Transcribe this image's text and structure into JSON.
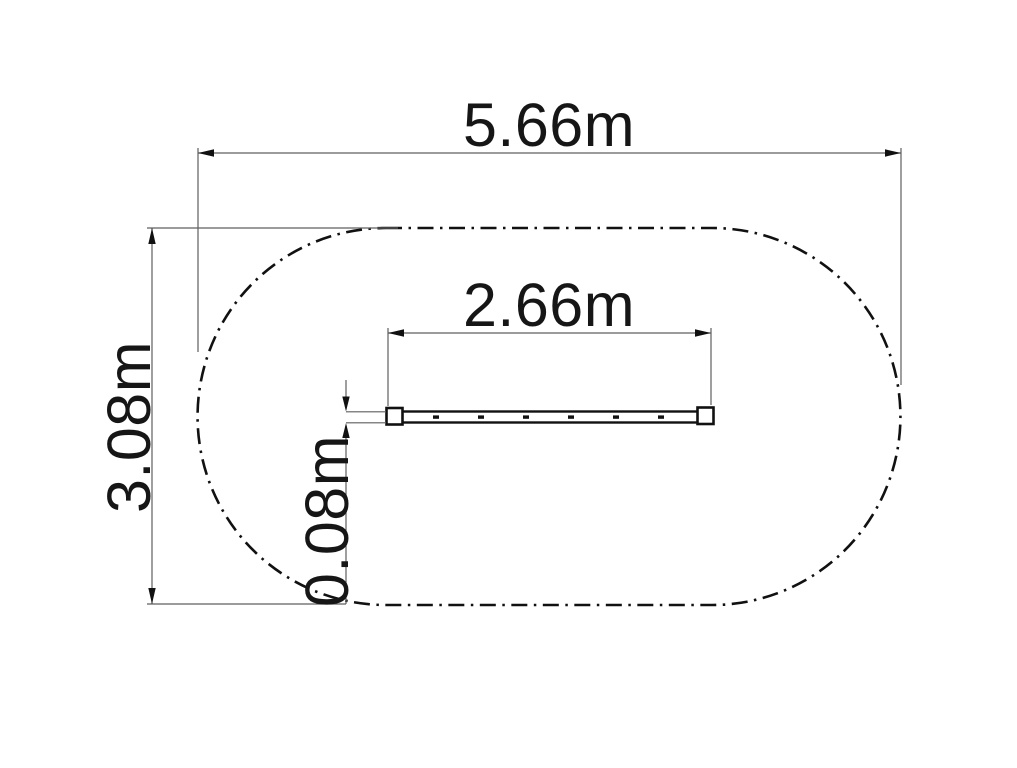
{
  "page": {
    "background_color": "#ffffff"
  },
  "drawing": {
    "kind": "technical plan drawing",
    "units": "m",
    "outline": {
      "shape": "stadium (rounded oval)",
      "line_style": "dash-dot",
      "color": "#111111"
    },
    "beam": {
      "description": "long narrow beam with square end caps and joint ticks",
      "color": "#111111"
    },
    "colors": {
      "object_line": "#111111",
      "dimension_line": "#5f5f5f",
      "text": "#161616"
    },
    "dimensions": {
      "overall_width": {
        "label": "5.66m",
        "value": 5.66
      },
      "overall_height": {
        "label": "3.08m",
        "value": 3.08
      },
      "beam_length": {
        "label": "2.66m",
        "value": 2.66
      },
      "beam_width": {
        "label": "0.08m",
        "value": 0.08
      }
    }
  }
}
